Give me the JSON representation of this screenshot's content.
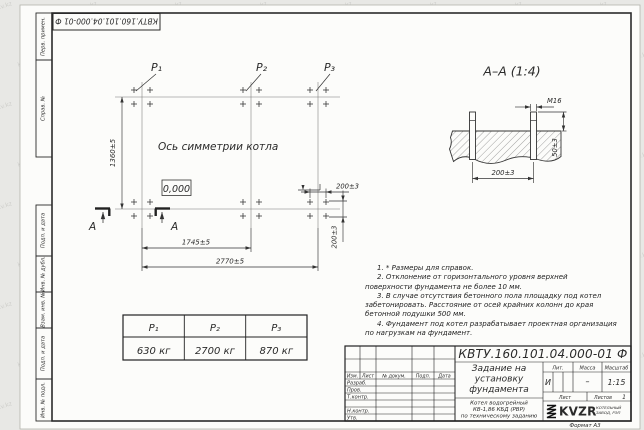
{
  "watermark": {
    "text": "kotlam-kv.kz"
  },
  "stamp": {
    "number": "КВТУ.160.101.04.000-01  Ф"
  },
  "sidebar": {
    "cells": [
      "Перв. примен.",
      "Справ. №",
      "Подп. и дата",
      "Инв. № дубл.",
      "Взам. инв. №",
      "Подп. и дата",
      "Инв. № подл."
    ]
  },
  "plan": {
    "p_labels": [
      "P₁",
      "P₂",
      "P₃"
    ],
    "symmetry_axis_label": "Ось симметрии котла",
    "level_mark": "0,000",
    "dim_height": "1360±5",
    "dim_p1_p2": "1745±5",
    "dim_p1_p3": "2770±5",
    "dim_bolt_x": "200±3",
    "dim_bolt_y": "200±3",
    "section_letter": "A"
  },
  "section": {
    "title": "A–A (1:4)",
    "bolt_thread": "M16",
    "dim_protrusion": "50±3",
    "dim_spacing": "200±3"
  },
  "load_table": {
    "headers": [
      "P₁",
      "P₂",
      "P₃"
    ],
    "values": [
      "630 кг",
      "2700 кг",
      "870 кг"
    ]
  },
  "notes": [
    "1. * Размеры для справок.",
    "2. Отклонение от горизонтального уровня верхней поверхности фундамента не более 10 мм.",
    "3. В случае отсутствия бетонного пола площадку под котел забетонировать. Расстояние от осей крайних колонн до края бетонной подушки 500 мм.",
    "4. Фундамент под котел разрабатывает проектная организация по нагрузкам на фундамент."
  ],
  "title_block": {
    "doc_number": "КВТУ.160.101.04.000-01  Ф",
    "header_cols": [
      "Изм.",
      "Лист",
      "№ докум.",
      "Подп.",
      "Дата"
    ],
    "sig_labels": [
      "Разраб.",
      "Пров.",
      "Т.контр.",
      "Н.контр.",
      "Утв."
    ],
    "title_lines": [
      "Задание на",
      "установку",
      "фундамента"
    ],
    "subtitle_lines": [
      "Котел водогрейный",
      "КВ-1,86 КБД (РВР)",
      "по техническому заданию"
    ],
    "lit_header": "Лит.",
    "mass_header": "Масса",
    "scale_header": "Масштаб",
    "lit_value": "И",
    "mass_value": "–",
    "scale_value": "1:15",
    "sheet_label": "Лист",
    "sheets_label": "Листов",
    "sheets_value": "1",
    "logo": {
      "name": "KVZR",
      "sub1": "КОТЕЛЬНЫЙ",
      "sub2": "ЗАВОД, РЭП"
    },
    "format_label": "Формат А3"
  }
}
